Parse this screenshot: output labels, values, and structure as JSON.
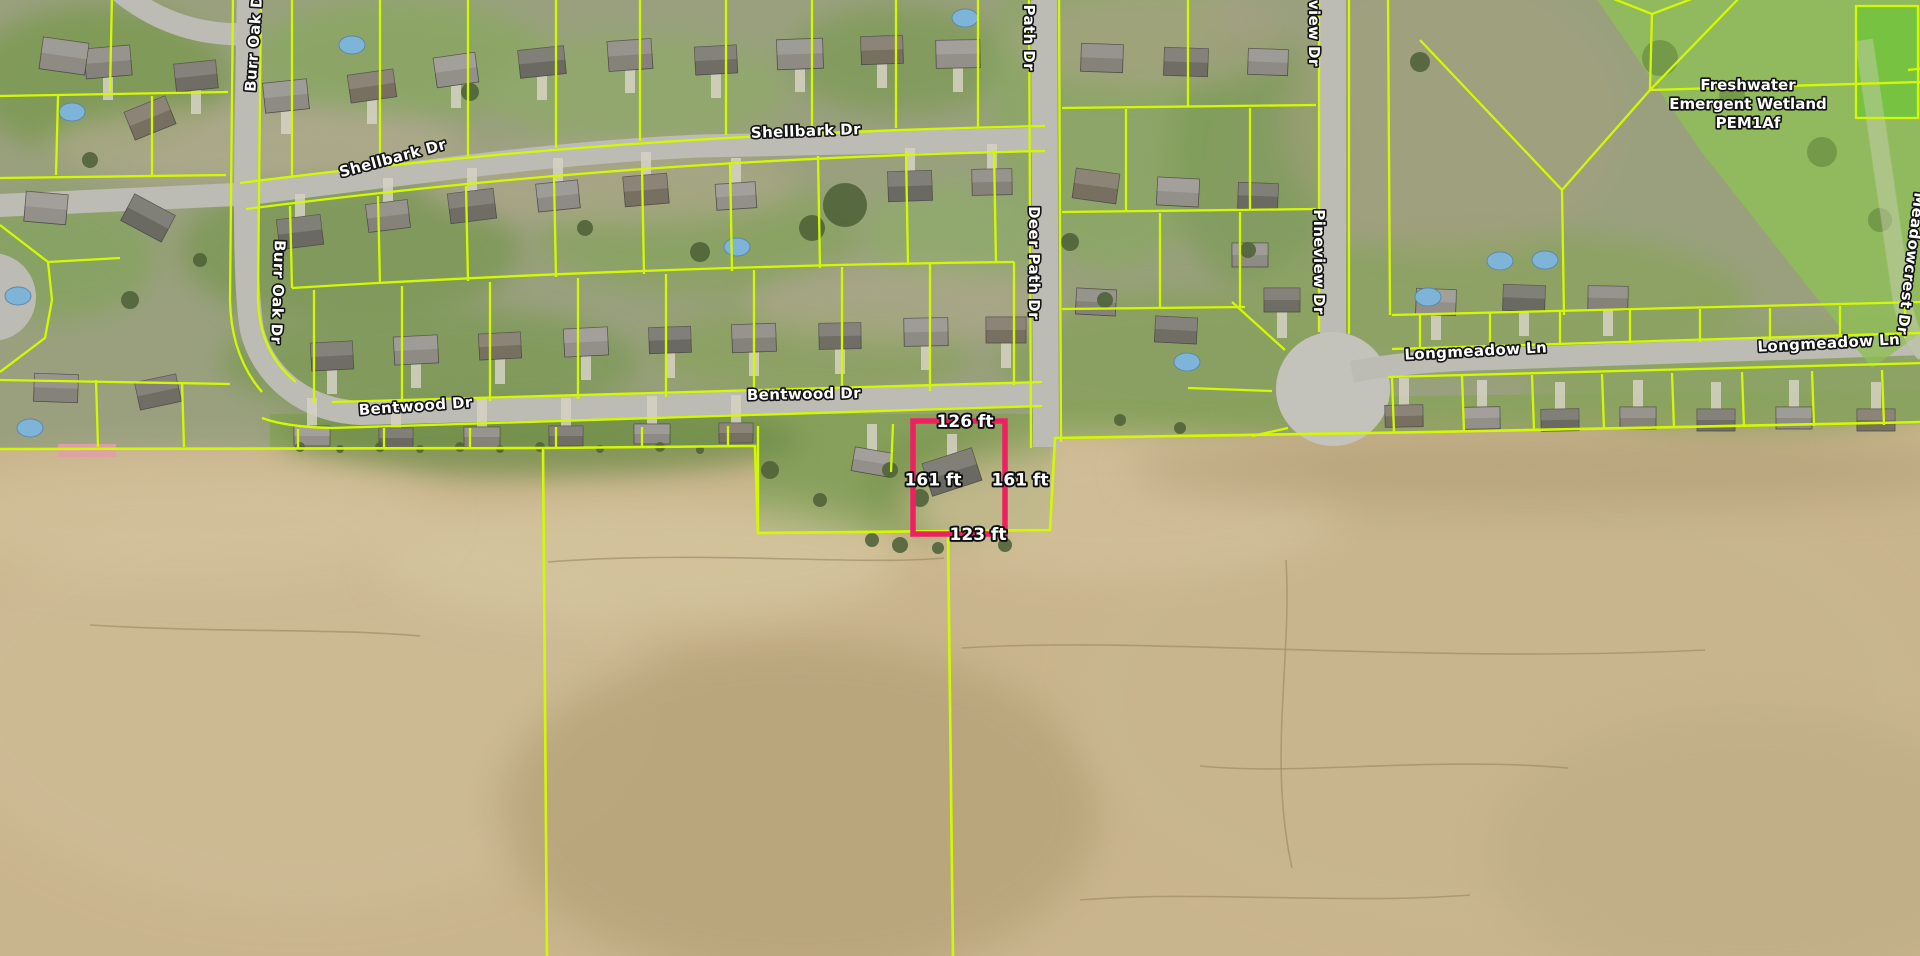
{
  "map": {
    "type": "aerial-parcel-map",
    "colors": {
      "parcel_line": "#d3f902",
      "selected_parcel_outline": "#ed2162",
      "label_fill": "#ffffff",
      "label_halo": "#141414"
    },
    "street_labels": [
      {
        "id": "burr-oak-dr-north",
        "text": "Burr Oak Dr",
        "x": 259,
        "y": 40,
        "rotation": -86
      },
      {
        "id": "burr-oak-dr-south",
        "text": "Burr Oak Dr",
        "x": 273,
        "y": 292,
        "rotation": 92
      },
      {
        "id": "shellbark-dr-west",
        "text": "Shellbark Dr",
        "x": 394,
        "y": 163,
        "rotation": -15
      },
      {
        "id": "shellbark-dr-east",
        "text": "Shellbark Dr",
        "x": 806,
        "y": 136,
        "rotation": -2
      },
      {
        "id": "deer-path-dr-north",
        "text": "Deer Path Dr",
        "x": 1024,
        "y": 14,
        "rotation": 90
      },
      {
        "id": "deer-path-dr-south",
        "text": "Deer Path Dr",
        "x": 1029,
        "y": 263,
        "rotation": 90
      },
      {
        "id": "pineview-dr-north",
        "text": "Pineview Dr",
        "x": 1309,
        "y": 14,
        "rotation": 90
      },
      {
        "id": "pineview-dr-south",
        "text": "Pineview Dr",
        "x": 1314,
        "y": 262,
        "rotation": 90
      },
      {
        "id": "longmeadow-ln-west",
        "text": "Longmeadow Ln",
        "x": 1476,
        "y": 356,
        "rotation": -3
      },
      {
        "id": "longmeadow-ln-east",
        "text": "Longmeadow Ln",
        "x": 1829,
        "y": 348,
        "rotation": -3
      },
      {
        "id": "meadowcrest-dr",
        "text": "Meadowcrest Dr",
        "x": 1906,
        "y": 263,
        "rotation": 97
      },
      {
        "id": "bentwood-dr-west",
        "text": "Bentwood Dr",
        "x": 416,
        "y": 411,
        "rotation": -4
      },
      {
        "id": "bentwood-dr-east",
        "text": "Bentwood Dr",
        "x": 804,
        "y": 399,
        "rotation": -1
      }
    ],
    "wetland_label": {
      "lines": [
        "Freshwater",
        "Emergent Wetland",
        "PEM1Af"
      ],
      "x": 1748,
      "y": 90,
      "line_height": 19
    },
    "selected_parcel": {
      "x": 913,
      "y": 421,
      "width": 92,
      "height": 113,
      "dimensions": {
        "top": "126 ft",
        "right": "161 ft",
        "bottom": "123 ft",
        "left": "161 ft"
      }
    }
  }
}
